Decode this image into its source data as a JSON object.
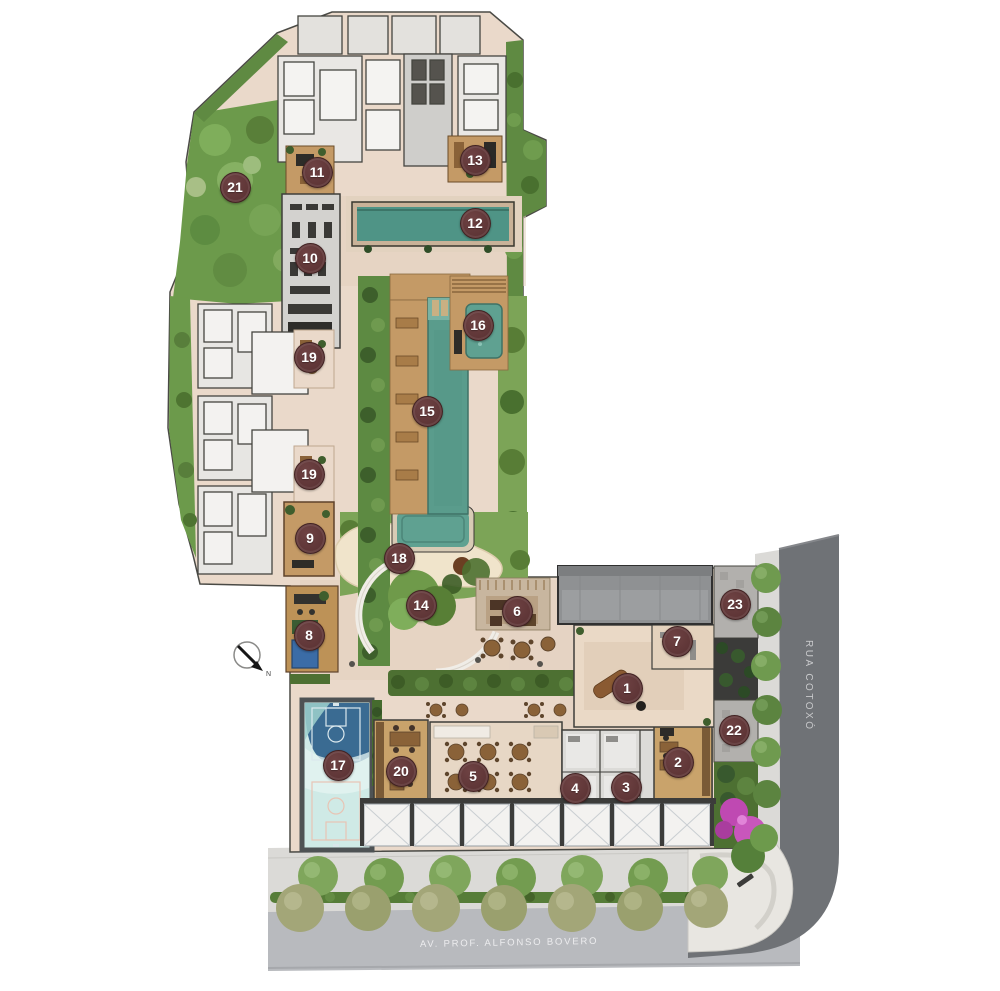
{
  "plan": {
    "streets": {
      "right_name": "RUA COTOXÓ",
      "bottom_name": "AV. PROF. ALFONSO BOVERO"
    },
    "compass": {
      "label": "N"
    },
    "markers": [
      {
        "n": "1",
        "x": 626,
        "y": 687
      },
      {
        "n": "2",
        "x": 677,
        "y": 761
      },
      {
        "n": "3",
        "x": 625,
        "y": 786
      },
      {
        "n": "4",
        "x": 574,
        "y": 787
      },
      {
        "n": "5",
        "x": 472,
        "y": 775
      },
      {
        "n": "6",
        "x": 516,
        "y": 610
      },
      {
        "n": "7",
        "x": 676,
        "y": 640
      },
      {
        "n": "8",
        "x": 308,
        "y": 634
      },
      {
        "n": "9",
        "x": 309,
        "y": 537
      },
      {
        "n": "10",
        "x": 309,
        "y": 257
      },
      {
        "n": "11",
        "x": 316,
        "y": 171
      },
      {
        "n": "12",
        "x": 474,
        "y": 222
      },
      {
        "n": "13",
        "x": 474,
        "y": 159
      },
      {
        "n": "14",
        "x": 420,
        "y": 604
      },
      {
        "n": "15",
        "x": 426,
        "y": 410
      },
      {
        "n": "16",
        "x": 477,
        "y": 324
      },
      {
        "n": "17",
        "x": 337,
        "y": 764
      },
      {
        "n": "18",
        "x": 398,
        "y": 557
      },
      {
        "n": "19",
        "x": 308,
        "y": 356
      },
      {
        "n": "19",
        "x": 308,
        "y": 473
      },
      {
        "n": "20",
        "x": 400,
        "y": 770
      },
      {
        "n": "21",
        "x": 234,
        "y": 186
      },
      {
        "n": "22",
        "x": 733,
        "y": 729
      },
      {
        "n": "23",
        "x": 734,
        "y": 603
      }
    ],
    "colors": {
      "marker_bg": "#5e3536",
      "marker_text": "#ffffff",
      "street_dark": "#6f7276",
      "street_light": "#b8babe",
      "paving": "#ead9ca",
      "pool_water": "#579a8a",
      "court_blue": "#3a6b92",
      "lawn": "#7ca457",
      "wood_deck": "#c49a66"
    }
  }
}
